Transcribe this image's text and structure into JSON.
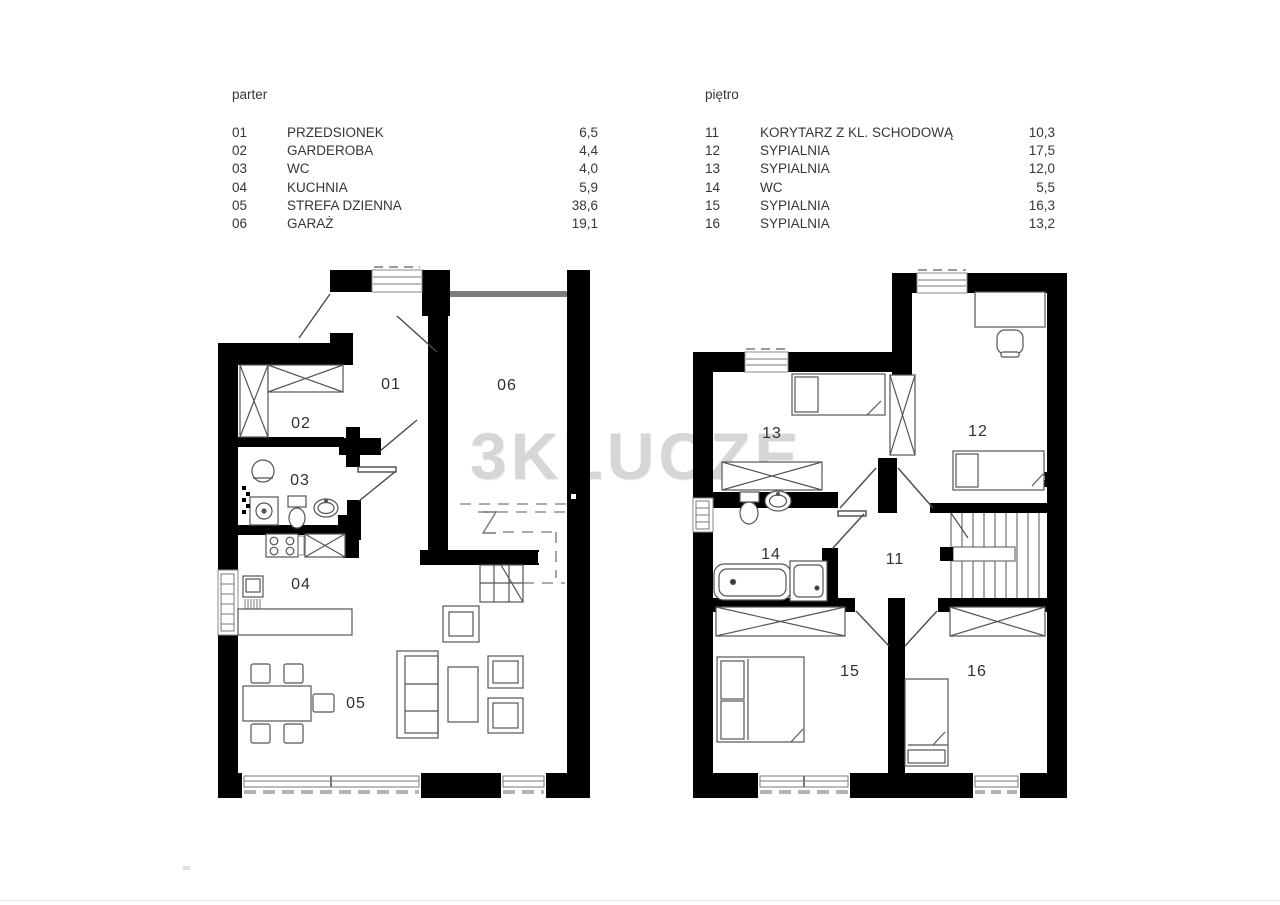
{
  "watermark": {
    "text": "3KLUCZE",
    "color": "#d6d6d6"
  },
  "legends": {
    "parter": {
      "title": "parter",
      "rows": [
        {
          "no": "01",
          "name": "PRZEDSIONEK",
          "area": "6,5"
        },
        {
          "no": "02",
          "name": "GARDEROBA",
          "area": "4,4"
        },
        {
          "no": "03",
          "name": "WC",
          "area": "4,0"
        },
        {
          "no": "04",
          "name": "KUCHNIA",
          "area": "5,9"
        },
        {
          "no": "05",
          "name": "STREFA DZIENNA",
          "area": "38,6"
        },
        {
          "no": "06",
          "name": "GARAŻ",
          "area": "19,1"
        }
      ]
    },
    "pietro": {
      "title": "piętro",
      "rows": [
        {
          "no": "11",
          "name": "KORYTARZ Z KL. SCHODOWĄ",
          "area": "10,3"
        },
        {
          "no": "12",
          "name": "SYPIALNIA",
          "area": "17,5"
        },
        {
          "no": "13",
          "name": "SYPIALNIA",
          "area": "12,0"
        },
        {
          "no": "14",
          "name": "WC",
          "area": "5,5"
        },
        {
          "no": "15",
          "name": "SYPIALNIA",
          "area": "16,3"
        },
        {
          "no": "16",
          "name": "SYPIALNIA",
          "area": "13,2"
        }
      ]
    }
  },
  "plans": {
    "parter": {
      "room_labels": [
        "01",
        "02",
        "03",
        "04",
        "05",
        "06"
      ]
    },
    "pietro": {
      "room_labels": [
        "11",
        "12",
        "13",
        "14",
        "15",
        "16"
      ]
    }
  },
  "colors": {
    "wall": "#000000",
    "furniture_line": "#555555",
    "door_line": "#4a4a4a",
    "dash": "#9a9a9a",
    "watermark": "#d6d6d6"
  }
}
